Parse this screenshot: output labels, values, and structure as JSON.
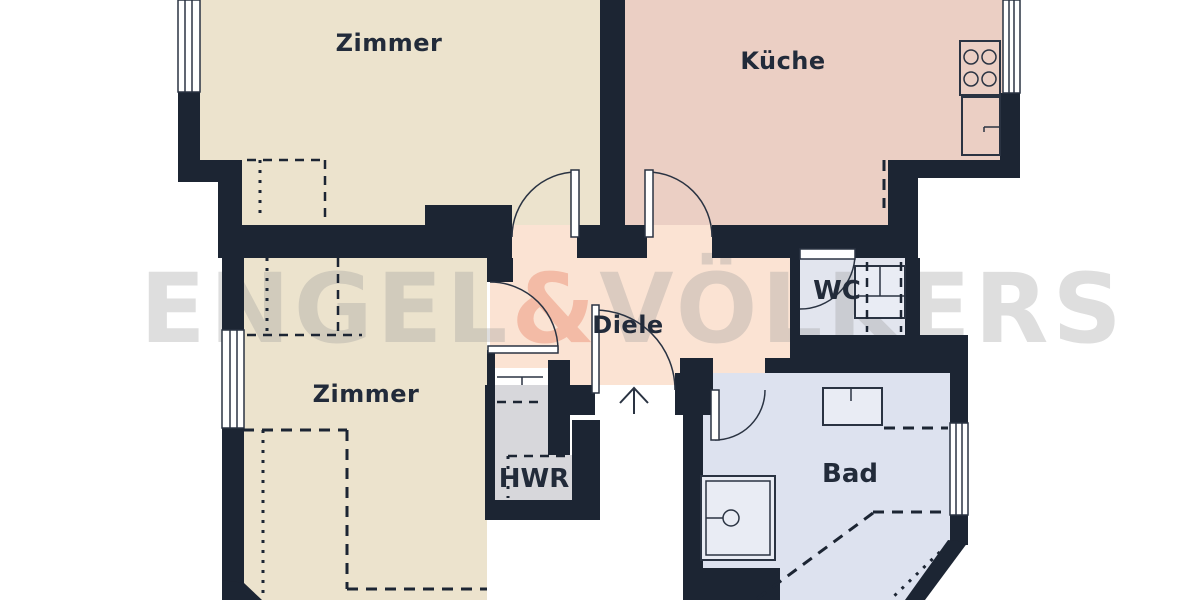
{
  "title": "Wohnung Grundriss (floor plan)",
  "watermark": {
    "part1": "ENGEL",
    "amp": "&",
    "part2": "VÖLKERS"
  },
  "rooms": [
    {
      "id": "zimmer-top",
      "label": "Zimmer"
    },
    {
      "id": "kueche",
      "label": "Küche"
    },
    {
      "id": "zimmer-bottom",
      "label": "Zimmer"
    },
    {
      "id": "diele",
      "label": "Diele"
    },
    {
      "id": "wc",
      "label": "WC"
    },
    {
      "id": "hwr",
      "label": "HWR"
    },
    {
      "id": "bad",
      "label": "Bad"
    }
  ],
  "colors": {
    "wall": "#1c2533",
    "line": "#2a3342",
    "label": "#222b3a",
    "zimmer": "#ece3cd",
    "kueche": "#ebcfc4",
    "diele": "#fbe3d3",
    "wc": "#e2e5ee",
    "bad": "#dde2ef",
    "hwr": "#d7d7db",
    "fixture": "#e9ecf4",
    "wmgray": "#9a9a9a",
    "wmamp": "#e4684a"
  }
}
